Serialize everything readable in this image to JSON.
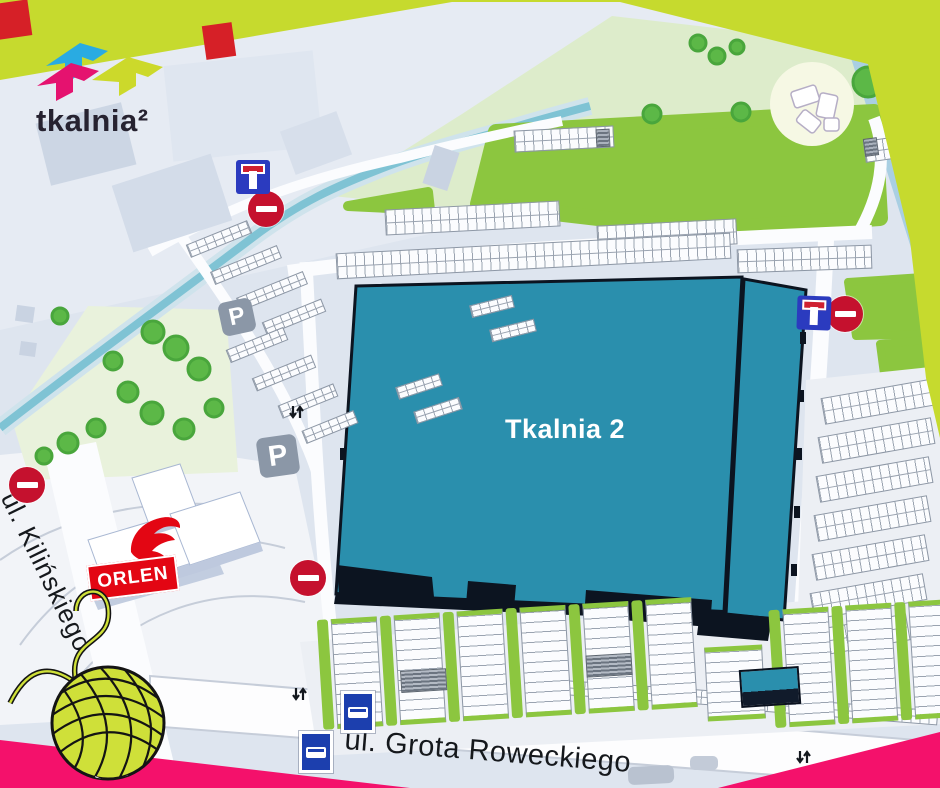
{
  "brand": {
    "logo_text": "tkalnia²",
    "logo_mark_colors": {
      "cyan": "#29abe2",
      "magenta": "#e5126f",
      "lime": "#ccd92b"
    },
    "logo_text_color": "#262230"
  },
  "frame": {
    "top_band_color": "#c6da2e",
    "bottom_band_color": "#f4116b",
    "confetti_red": "#d62027"
  },
  "map": {
    "building": {
      "label": "Tkalnia 2",
      "fill_color": "#2a8fad",
      "outline_color": "#0c1420",
      "label_color": "#ffffff"
    },
    "streets": {
      "kilinskiego": "ul. Kilińskiego",
      "grota_roweckiego": "ul. Grota Roweckiego"
    },
    "orlen": {
      "label": "ORLEN",
      "brand_color": "#e30613"
    },
    "signs": {
      "parking_glyph": "P"
    },
    "colors": {
      "map_base": "#dee5ef",
      "water": "#a9cfe2",
      "canal": "#7fc3d4",
      "lawn_green": "#8cc63f",
      "park_green": "#ddeccb"
    }
  }
}
